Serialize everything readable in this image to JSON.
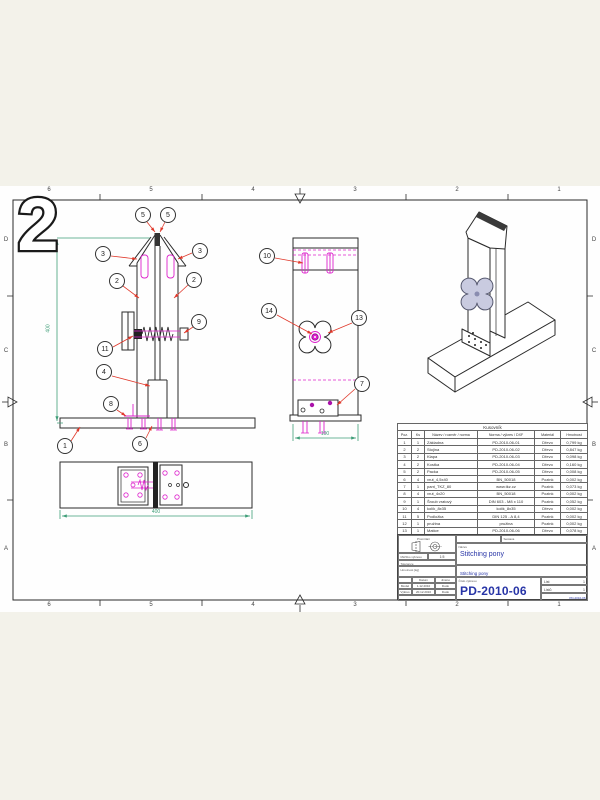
{
  "page": {
    "stamp": "2"
  },
  "border": {
    "top": [
      "6",
      "5",
      "4",
      "3",
      "2",
      "1"
    ],
    "bottom": [
      "6",
      "5",
      "4",
      "3",
      "2",
      "1"
    ],
    "left": [
      "D",
      "C",
      "B",
      "A"
    ],
    "right": [
      "D",
      "C",
      "B",
      "A"
    ]
  },
  "balloons": {
    "front": [
      "5",
      "5",
      "3",
      "3",
      "2",
      "2",
      "9",
      "11",
      "4",
      "8",
      "1",
      "6"
    ],
    "side": [
      "10",
      "14",
      "13",
      "7"
    ]
  },
  "dimensions": {
    "front_height": "400",
    "base_width": "400",
    "side_width": "100"
  },
  "parts_table": {
    "title": "Kusovník",
    "columns": [
      "Poz.",
      "Ks",
      "Název / rozměr / norma",
      "Norma / výkres / DXF",
      "Materiál",
      "Hmotnost"
    ],
    "rows": [
      {
        "poz": "1",
        "ks": "1",
        "nazev": "Základna",
        "norma": "PD-2010-06-01",
        "material": "Dřevo",
        "hmotnost": "0,799 kg"
      },
      {
        "poz": "2",
        "ks": "2",
        "nazev": "Stojina",
        "norma": "PD-2010-06-02",
        "material": "Dřevo",
        "hmotnost": "0,847 kg"
      },
      {
        "poz": "3",
        "ks": "2",
        "nazev": "Klapa",
        "norma": "PD-2010-06-03",
        "material": "Dřevo",
        "hmotnost": "0,098 kg"
      },
      {
        "poz": "4",
        "ks": "2",
        "nazev": "Kostka",
        "norma": "PD-2010-06-04",
        "material": "Dřevo",
        "hmotnost": "0,160 kg"
      },
      {
        "poz": "5",
        "ks": "2",
        "nazev": "Packa",
        "norma": "PD-2010-06-05",
        "material": "Dřevo",
        "hmotnost": "0,008 kg"
      },
      {
        "poz": "6",
        "ks": "4",
        "nazev": "vrut_4,5x40",
        "norma": "BN_50018",
        "material": "Pozink",
        "hmotnost": "0,002 kg"
      },
      {
        "poz": "7",
        "ks": "1",
        "nazev": "pant_TKZ_80",
        "norma": "www.tkz.cz",
        "material": "Pozink",
        "hmotnost": "0,073 kg"
      },
      {
        "poz": "8",
        "ks": "4",
        "nazev": "vrut_4x20",
        "norma": "BN_50018",
        "material": "Pozink",
        "hmotnost": "0,002 kg"
      },
      {
        "poz": "9",
        "ks": "1",
        "nazev": "Šroub vratový",
        "norma": "DIN 603 - M8 x 110",
        "material": "Pozink",
        "hmotnost": "0,052 kg"
      },
      {
        "poz": "10",
        "ks": "4",
        "nazev": "kolík_8x35",
        "norma": "kolík_8x35",
        "material": "Dřevo",
        "hmotnost": "0,002 kg"
      },
      {
        "poz": "11",
        "ks": "5",
        "nazev": "Podložka",
        "norma": "DIN 125 - A 8,4",
        "material": "Pozink",
        "hmotnost": "0,002 kg"
      },
      {
        "poz": "12",
        "ks": "1",
        "nazev": "pružina",
        "norma": "pružina",
        "material": "Pozink",
        "hmotnost": "0,002 kg"
      },
      {
        "poz": "13",
        "ks": "1",
        "nazev": "Matice",
        "norma": "PD-2010-06-06",
        "material": "Dřevo",
        "hmotnost": "0,078 kg"
      },
      {
        "poz": "14",
        "ks": "1",
        "nazev": "Matice M8 zarážecí",
        "norma": "BN_226_M8",
        "material": "Pozink",
        "hmotnost": "0,007 kg"
      }
    ]
  },
  "title_block": {
    "promitani_label": "Promítání",
    "sestava_label": "Sestava",
    "meritko_label": "Měřítko výkresu",
    "meritko_value": "1:5",
    "tolerance_label": "Tolerance",
    "hmotnost_label": "Hmotnost [kg]",
    "datum_label": "Datum",
    "jmeno_label": "Jméno",
    "rows": [
      {
        "role": "Model",
        "datum": "1.12.2010",
        "jmeno": "Dudo"
      },
      {
        "role": "Výkres",
        "datum": "20.12.2010",
        "jmeno": "Dudo"
      }
    ],
    "nazev_label": "Název",
    "title_main": "Stitching pony",
    "title_sub": "Stitching pony",
    "cislo_label": "Číslo výkresu",
    "drawing_number": "PD-2010-06",
    "list_label": "List",
    "list_value": "1",
    "listu_label": "Listů",
    "listu_value": "1",
    "footer_number": "PD-2010-06"
  },
  "colors": {
    "magenta": "#dd22cc",
    "dim_green": "#3f9e78",
    "leader_red": "#e0392b",
    "title_blue": "#2734a6",
    "line": "#2b2b2b",
    "paper": "#fefefe",
    "backdrop": "#f3f2ea"
  }
}
